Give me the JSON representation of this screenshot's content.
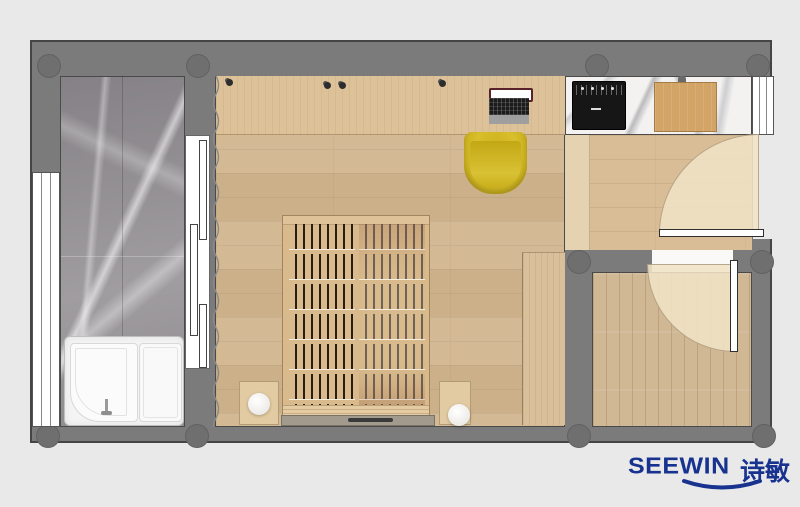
{
  "brand": {
    "name_en": "SEEWIN",
    "name_zh": "诗敏",
    "logo_color": "#17338f"
  },
  "palette": {
    "background": "#e9e9e9",
    "wall": "#7b7b7b",
    "wall_outline": "#454545",
    "wood_floor_main": "#d2b68e",
    "wood_floor_hallway": "#d8bd96",
    "wood_floor_room2": "#d0b894",
    "desk_wood": "#ddc199",
    "marble_gray_floor": "#a09da0",
    "marble_white_counter": "#f3f2f1",
    "door_swing_area": "#f0e2c6",
    "chair_yellow": "#d2b81f",
    "cooktop_black": "#161616",
    "cutting_board": "#d2a466",
    "bed_wood": "#d8ba8c",
    "tub_white": "#f4f4f4"
  },
  "floorplan": {
    "rooms": [
      {
        "id": "balcony-bathroom",
        "floor": "gray-marble",
        "features": [
          "left-window",
          "shower-tub",
          "sliding-door"
        ]
      },
      {
        "id": "main-room",
        "floor": "wood-plank",
        "features": [
          "desk-counter",
          "laptop",
          "yellow-chair",
          "slatted-bed",
          "nightstand-left",
          "nightstand-right",
          "round-lamp-left",
          "round-lamp-right",
          "wardrobe",
          "curtain"
        ]
      },
      {
        "id": "kitchen-entry",
        "floor": "wood-plank",
        "features": [
          "marble-counter",
          "induction-cooktop",
          "cutting-board",
          "right-window",
          "entry-door-swing"
        ]
      },
      {
        "id": "small-room",
        "floor": "wood-plank",
        "features": [
          "door-swing",
          "doorway"
        ]
      }
    ]
  }
}
